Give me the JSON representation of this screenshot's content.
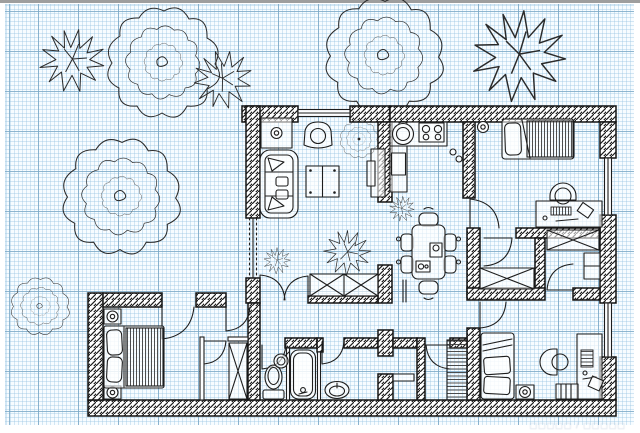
{
  "meta": {
    "description": "Hand-drawn apartment floor plan sketched in black ink on blue graph paper, trees and shrubs drawn outside the walls",
    "canvas": {
      "width": 640,
      "height": 433
    }
  },
  "colors": {
    "paper": "#f7fcff",
    "grid_minor": "#d3e7f2",
    "grid_major": "#9cc3da",
    "ink": "#1d1d1d",
    "wall_hatch": "#141414",
    "watermark": "#9fb3cc",
    "top_edge": "#7d7d7d"
  },
  "watermark": {
    "text": "□□□□□ / □□□□□"
  },
  "plan": {
    "rooms": [
      {
        "name": "living-room",
        "furniture": [
          "sofa",
          "armchair",
          "coffee-table",
          "tv-cabinet",
          "cabinet-with-lamp",
          "flower-medallion"
        ]
      },
      {
        "name": "kitchen",
        "furniture": [
          "counter",
          "round-sink",
          "stove-4-burner",
          "fridge"
        ]
      },
      {
        "name": "dining-area",
        "furniture": [
          "dining-table",
          "six-chairs",
          "sideboard-x",
          "potted-plants"
        ]
      },
      {
        "name": "bedroom-top-right",
        "furniture": [
          "single-bed",
          "desk",
          "office-chair",
          "ceiling-lamp"
        ]
      },
      {
        "name": "walk-in-closet-left",
        "furniture": [
          "wardrobe-x"
        ]
      },
      {
        "name": "walk-in-closet-right",
        "furniture": [
          "wardrobe-x",
          "shelf"
        ]
      },
      {
        "name": "bedroom-bottom-left",
        "furniture": [
          "double-bed",
          "nightstand",
          "nightstand",
          "wardrobe-x"
        ]
      },
      {
        "name": "wc",
        "furniture": [
          "toilet",
          "round-basin"
        ]
      },
      {
        "name": "bathroom",
        "furniture": [
          "bathtub",
          "oval-basin"
        ]
      },
      {
        "name": "laundry-nook",
        "furniture": [
          "shelf-counter",
          "slatted-cabinet"
        ]
      },
      {
        "name": "bedroom-bottom-right",
        "furniture": [
          "single-bed",
          "desk",
          "office-chair",
          "bookshelf",
          "stool-with-lamp"
        ]
      }
    ],
    "outdoor_plants": [
      {
        "name": "scribble-tree",
        "count": 4
      },
      {
        "name": "leaf-bush",
        "count": 3
      },
      {
        "name": "small-plant-scribble",
        "count": 3
      }
    ],
    "door_count": 11,
    "window_count": 4,
    "wardrobe_x_count": 4
  }
}
